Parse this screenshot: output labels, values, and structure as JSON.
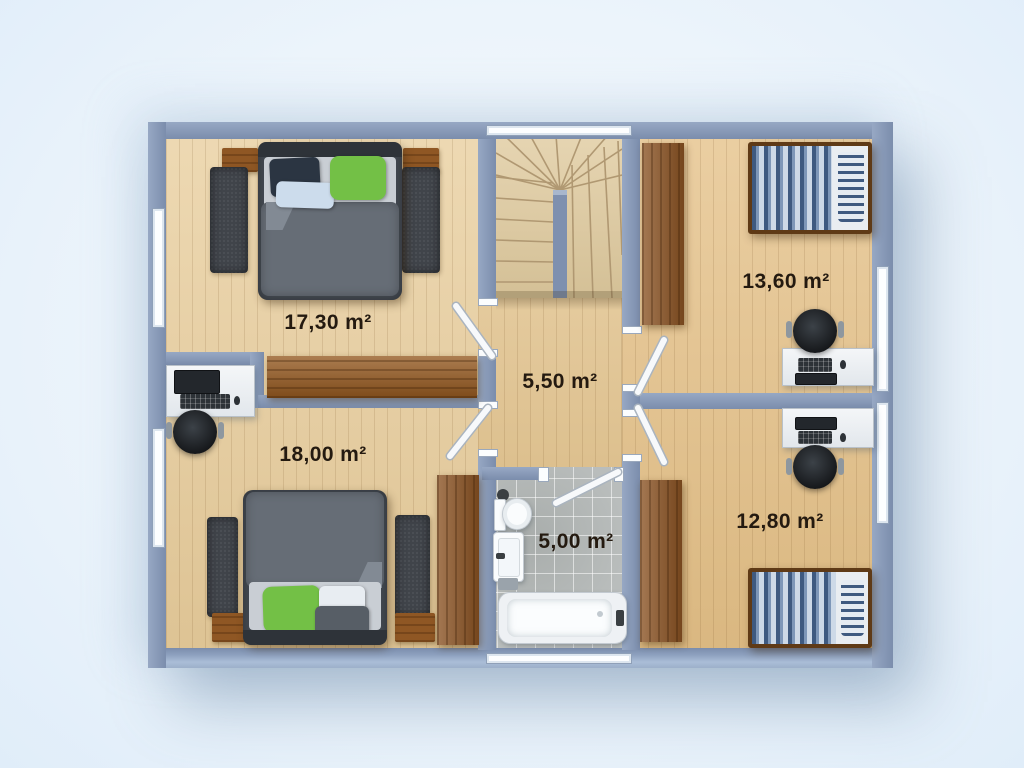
{
  "floor_plan": {
    "description": "Top-down 3D rendered upper-floor plan with two bedrooms left, two bedrooms right, central hallway with winder stairs, and bathroom",
    "rooms": [
      {
        "name": "bedroom-top-left",
        "area": "17,30 m²"
      },
      {
        "name": "bedroom-bottom-left",
        "area": "18,00 m²"
      },
      {
        "name": "hallway",
        "area": "5,50 m²"
      },
      {
        "name": "bedroom-top-right",
        "area": "13,60 m²"
      },
      {
        "name": "bedroom-bottom-right",
        "area": "12,80 m²"
      },
      {
        "name": "bathroom",
        "area": "5,00 m²"
      }
    ],
    "colors": {
      "background": "#e9f2fb",
      "walls": "#8093b2",
      "floor_wood_light": "#e9cf9f",
      "floor_wood_warm": "#e5c28a",
      "furniture_wood_dark": "#8a5222",
      "tile_gray": "#b9bdbc",
      "accent_green": "#72bf44",
      "bedding_blue": "#3f5a80",
      "label_text": "#241a10"
    }
  }
}
